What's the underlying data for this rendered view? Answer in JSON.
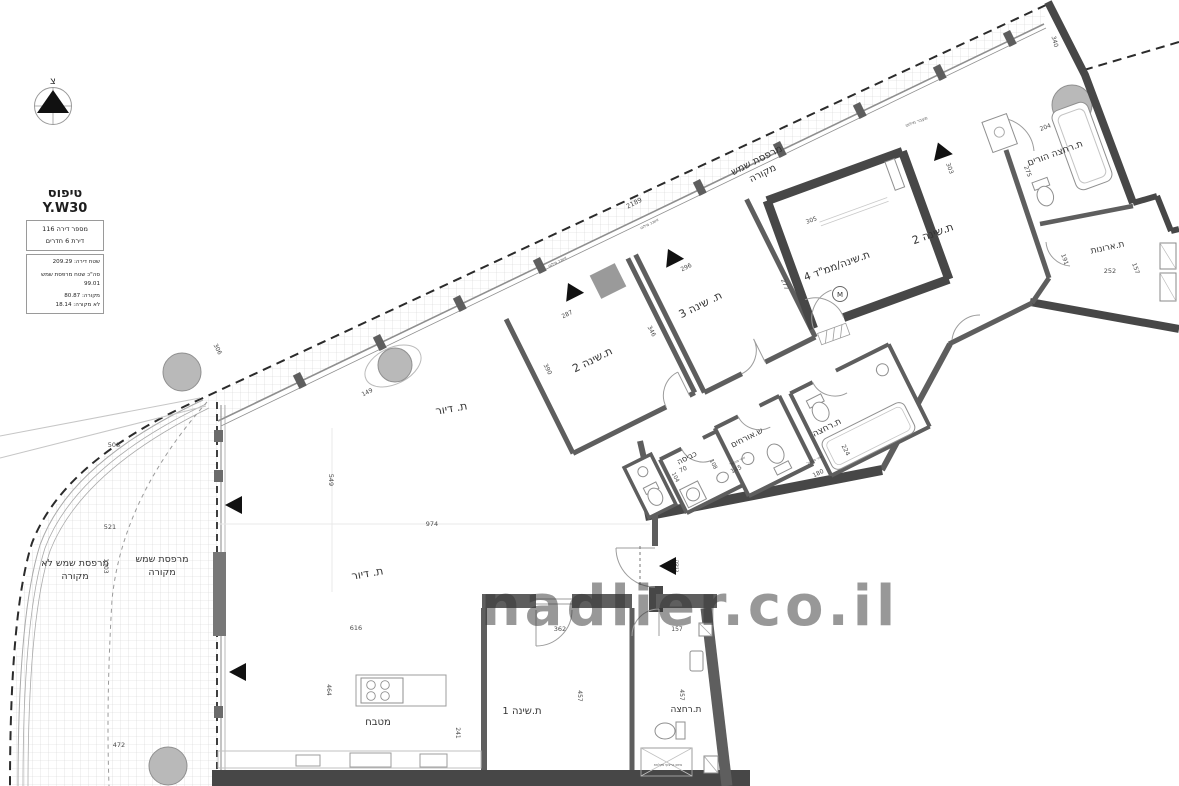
{
  "titleBlock": {
    "type": "טיפוס Y.W30",
    "apt": "מספר דירה 116",
    "rooms": "דירת 6 חדרים",
    "area": "שטח דירה: 209.29",
    "balconyTotal": "סה\"כ שטח מרפסת שמש",
    "balconyTotalValue": "99.01",
    "covered": "מקורה: 80.87",
    "uncovered": "לא מקורה: 18.14"
  },
  "compass": {
    "north": "צ"
  },
  "watermark": {
    "text": "nadlier.co.il"
  },
  "rooms": {
    "balconyTop1": "מרפסת שמש",
    "balconyTop2": "מקורה",
    "balconyLeftUncov1": "מרפסת שמש לא",
    "balconyLeftUncov2": "מקורה",
    "balconyLeftCov1": "מרפסת שמש",
    "balconyLeftCov2": "מקורה",
    "bedroom2mid": "ת.שינה 2",
    "bedroom3": "ת. שינה 3",
    "bedroom4": "ת.שינה/ממ\"ד 4",
    "mamadM": "M",
    "bedroom2top": "ת.שינה 2",
    "parentsBath": "ת.רחצה הורים",
    "closet": "ת.ארונות",
    "laundry": "כביסה",
    "guestWc": "ש.אורחים",
    "bathMid": "ת.רחצה",
    "living1": "ת. דיור",
    "living2": "ת. דיור",
    "kitchen": "מטבח",
    "bedroom1": "ת.שינה 1",
    "bathBottom": "ת.רחצה",
    "entrance": "כניסה"
  },
  "dims": {
    "total_top": "2189",
    "ne": "340",
    "pb_top": "204",
    "pb_h": "275",
    "b2t_h": "303",
    "closet_w": "252",
    "closet_h": "157",
    "closet_d": "191",
    "mamad_top": "305",
    "mamad_h": "277",
    "b3_top": "296",
    "b2m_top": "287",
    "b2m_hr": "346",
    "b2m_hl": "390",
    "lw": "306",
    "liv_top": "149",
    "liv_l": "549",
    "liv_w": "974",
    "liv_b": "616",
    "b1_top": "362",
    "bb_top": "157",
    "b1_h": "457",
    "bb_h": "457",
    "b1_d": "241",
    "kit_h": "464",
    "bal_1": "508",
    "bal_2": "521",
    "bal_v": "1103",
    "bal_3": "472",
    "laundry_w": "70",
    "guest_w": "145",
    "tub": "180",
    "guest_h": "108",
    "laundry_h": "104",
    "bath_h": "224"
  },
  "notes": {
    "escape1": "אשנב מילוט",
    "escape2": "אשנב מילוט",
    "escape3": "מעבר מילוט",
    "vent1": "אויר מפוצל",
    "vent2": "אויר מפוצל",
    "shower": "סימון בריצוף מקלחת"
  },
  "colors": {
    "wall": "#5e5e5e",
    "wallDark": "#474747",
    "hatchLine": "#cfcfcf",
    "boundaryDash": "#2b2b2b",
    "column": "#b9b9b9",
    "fixture": "#8f8f8f",
    "labelText": "#333333",
    "watermark": "#cdcdcd"
  }
}
